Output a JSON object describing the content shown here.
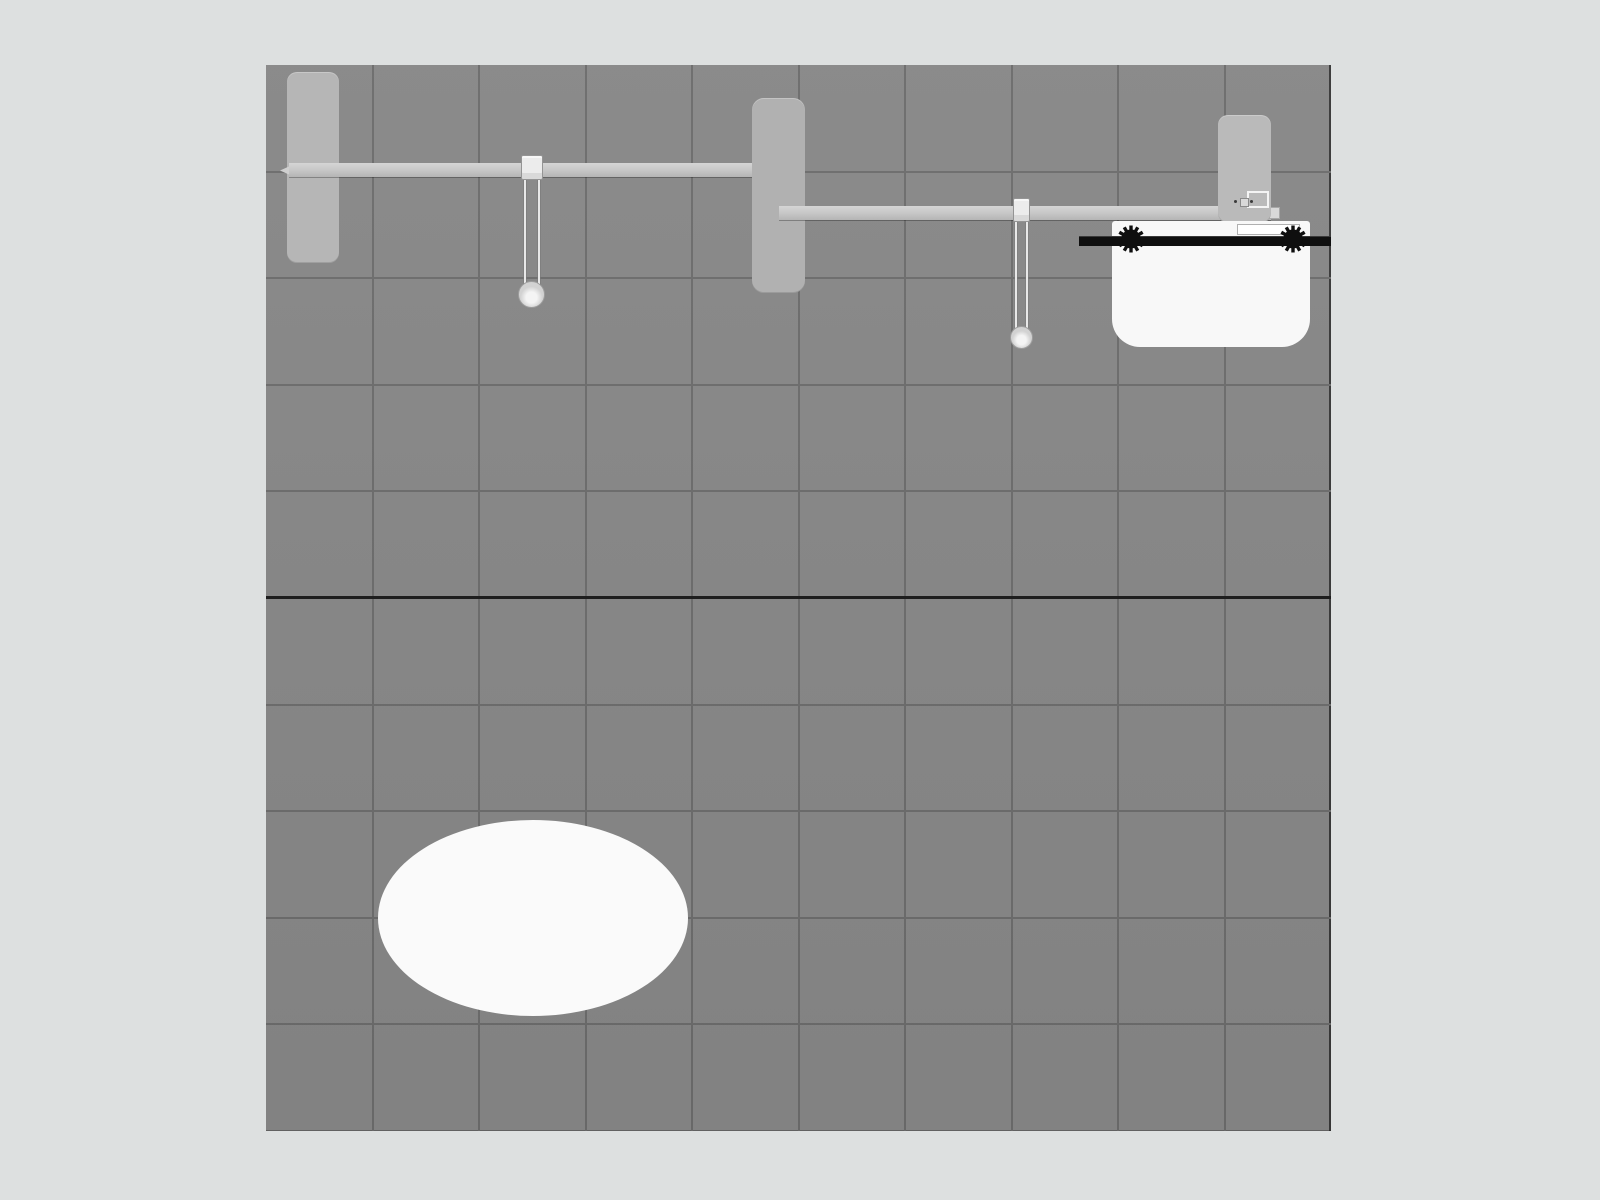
{
  "scene": {
    "view": "top-down-floor-plan",
    "floor_tiles": {
      "columns": 10,
      "rows": 10,
      "dark_row_index": 5
    }
  },
  "palette": {
    "background": "#dde0e0",
    "floor": "#878787",
    "grid_line": "#6c6c6c",
    "grid_line_dark": "#1b1b1b"
  },
  "objects": [
    {
      "id": "wall-panel-left",
      "type": "panel",
      "fill": "#b6b6b6"
    },
    {
      "id": "crossbar-left",
      "type": "beam",
      "fill": "#c9c9c9",
      "nub_fill": "#cfcfcf"
    },
    {
      "id": "light-fixture-left",
      "type": "hanging-light",
      "clamp_fill": "#ececec",
      "rod_fill": "#e8e8e8",
      "head_fill": "#d2d2d2"
    },
    {
      "id": "wall-panel-center",
      "type": "panel",
      "fill": "#b1b1b1"
    },
    {
      "id": "crossbar-right",
      "type": "beam",
      "fill": "#c9c9c9",
      "endcap_fill": "#d9d9d9"
    },
    {
      "id": "light-fixture-right",
      "type": "hanging-light",
      "clamp_fill": "#ececec",
      "rod_fill": "#e8e8e8",
      "head_fill": "#d2d2d2"
    },
    {
      "id": "wall-panel-right",
      "type": "panel",
      "fill": "#bababa"
    },
    {
      "id": "counter",
      "type": "counter",
      "fill": "#f8f8f8",
      "connector_fill": "#d9d9d9",
      "bolt_fill": "#3a3a3a"
    },
    {
      "id": "truss-bar",
      "type": "truss",
      "fill": "#0f0f0f",
      "clamp_count": 2
    },
    {
      "id": "oval-table",
      "type": "table",
      "fill": "#fafafa"
    }
  ]
}
